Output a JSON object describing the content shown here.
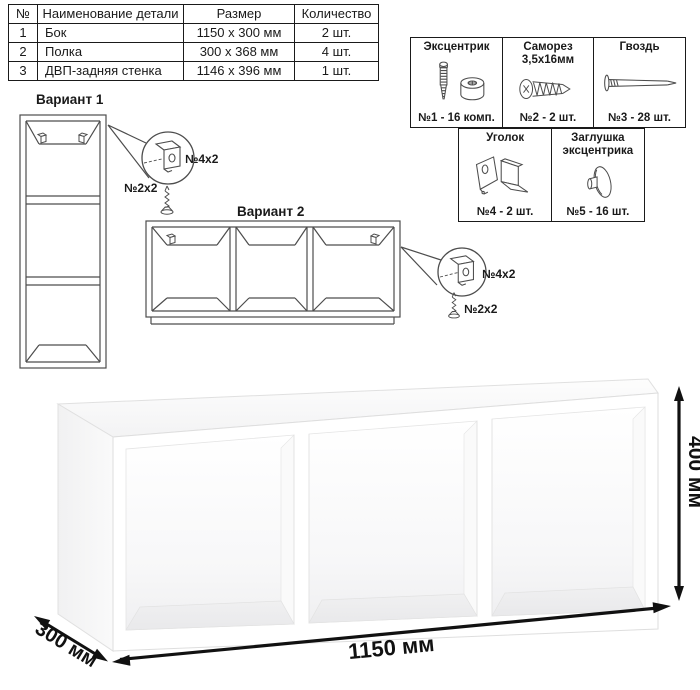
{
  "parts_table": {
    "headers": [
      "№",
      "Наименование детали",
      "Размер",
      "Количество"
    ],
    "rows": [
      {
        "num": "1",
        "name": "Бок",
        "size": "1150 x 300 мм",
        "qty": "2 шт."
      },
      {
        "num": "2",
        "name": "Полка",
        "size": "300 x 368 мм",
        "qty": "4 шт."
      },
      {
        "num": "3",
        "name": "ДВП-задняя стенка",
        "size": "1146 x 396 мм",
        "qty": "1 шт."
      }
    ]
  },
  "hardware": {
    "row1": [
      {
        "title": "Эксцентрик",
        "count": "№1 - 16 комп.",
        "icon": "eccentric-fitting-icon"
      },
      {
        "title": "Саморез\n3,5x16мм",
        "count": "№2 - 2 шт.",
        "icon": "screw-icon"
      },
      {
        "title": "Гвоздь",
        "count": "№3 - 28 шт.",
        "icon": "nail-icon"
      }
    ],
    "row2": [
      {
        "title": "Уголок",
        "count": "№4 - 2 шт.",
        "icon": "angle-bracket-icon"
      },
      {
        "title": "Заглушка\nэксцентрика",
        "count": "№5 - 16 шт.",
        "icon": "eccentric-cap-icon"
      }
    ]
  },
  "variants": {
    "v1": {
      "label": "Вариант 1",
      "bracket_qty": "№4x2",
      "screw_qty": "№2x2"
    },
    "v2": {
      "label": "Вариант 2",
      "bracket_qty": "№4x2",
      "screw_qty": "№2x2"
    }
  },
  "dimensions": {
    "width": "1150 мм",
    "depth": "300 мм",
    "height": "400 мм"
  },
  "colors": {
    "line_art": "#4d4d4d",
    "dimension": "#111111",
    "table_border": "#1a1a1a"
  }
}
